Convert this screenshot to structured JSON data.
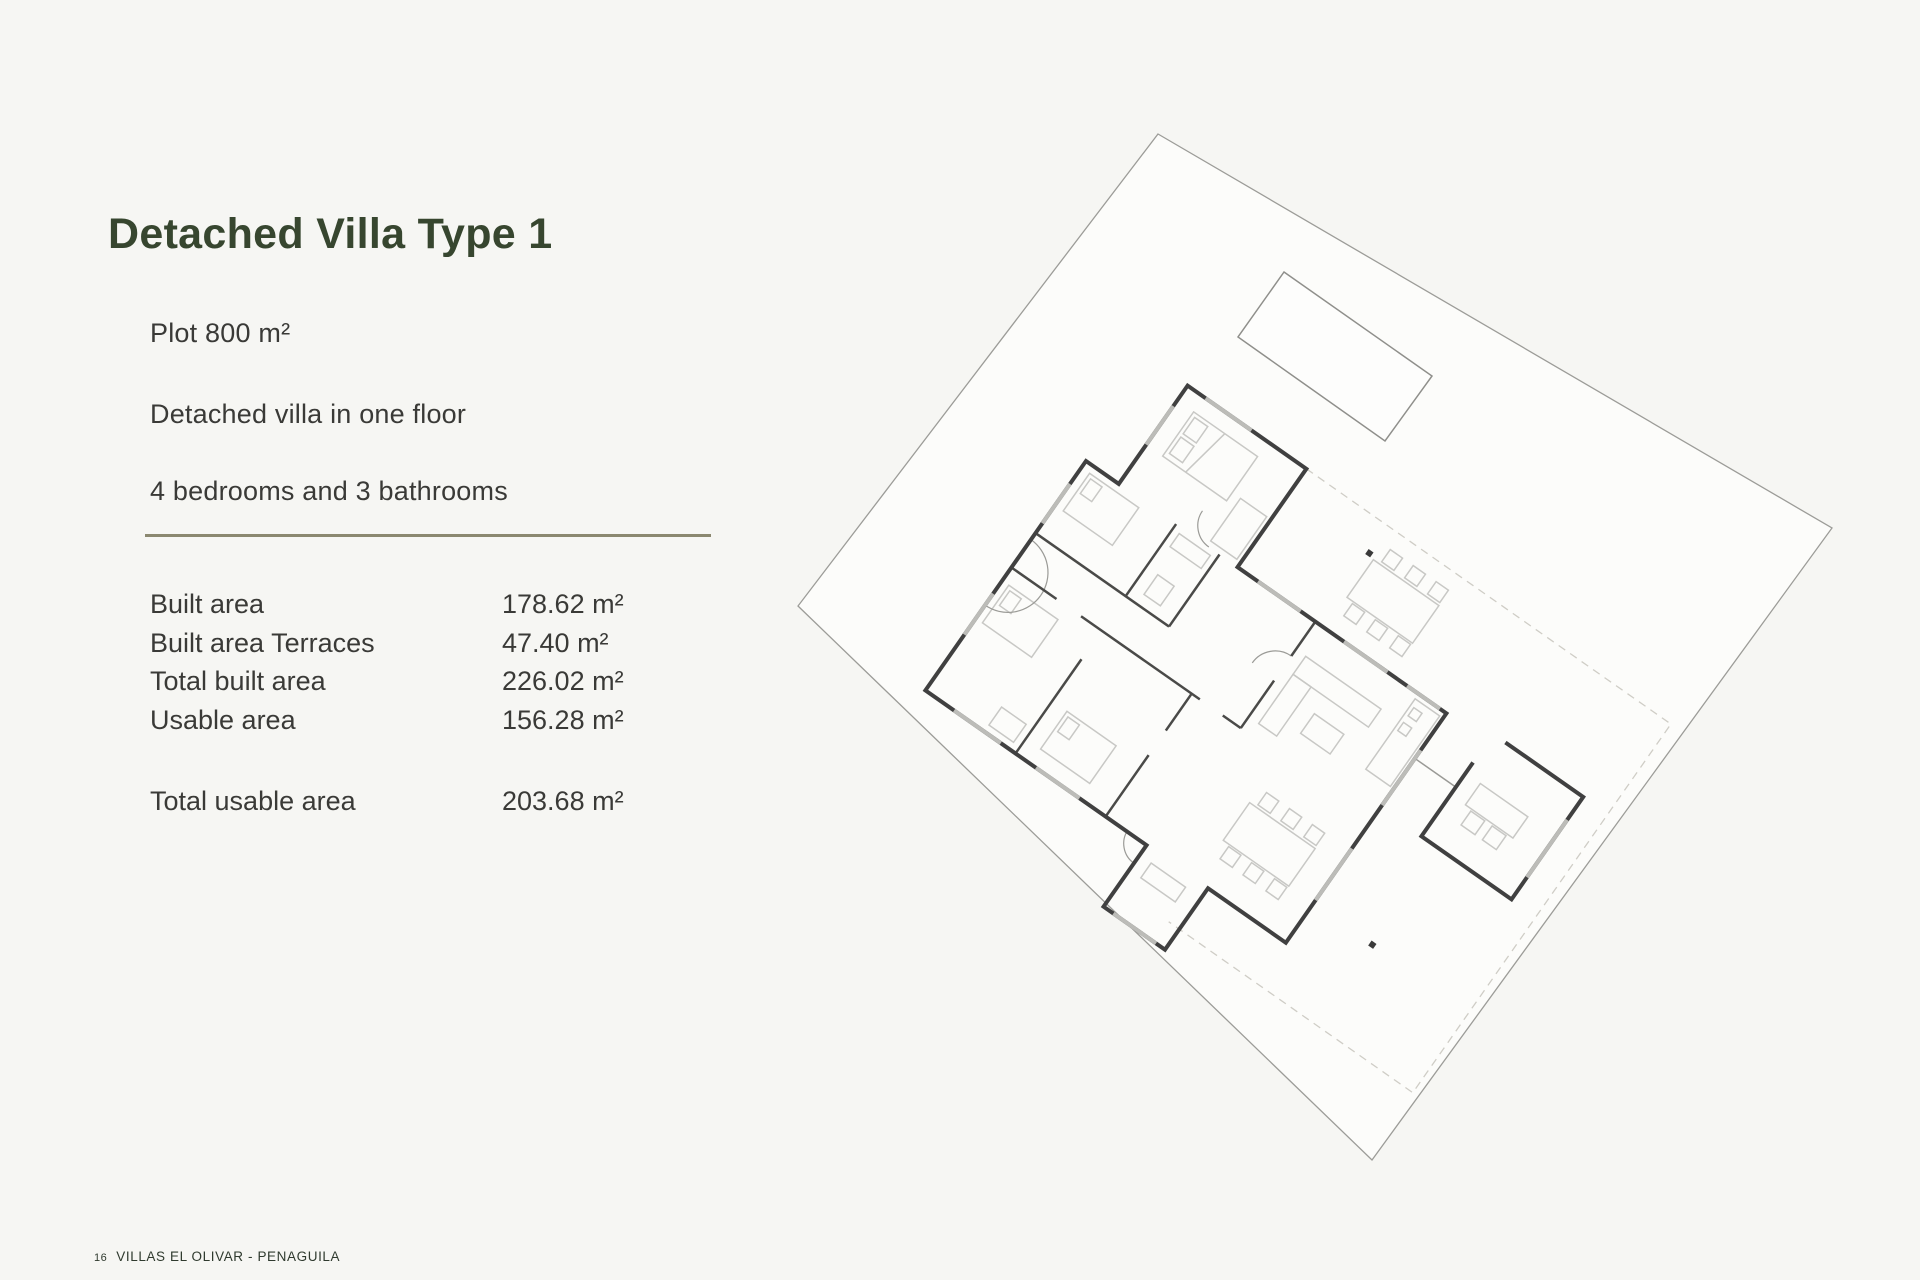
{
  "page": {
    "title": "Detached Villa Type 1"
  },
  "specs": {
    "intro_lines": [
      "Plot 800 m²",
      "Detached villa in one floor",
      "4 bedrooms and 3 bathrooms"
    ],
    "area_rows": [
      {
        "label": "Built area",
        "value": "178.62 m²"
      },
      {
        "label": "Built area Terraces",
        "value": "47.40 m²"
      },
      {
        "label": "Total built area",
        "value": "226.02 m²"
      },
      {
        "label": "Usable area",
        "value": "156.28 m²"
      }
    ],
    "total_row": {
      "label": "Total usable area",
      "value": "203.68 m²"
    }
  },
  "footer": {
    "page_number": "16",
    "project": "VILLAS EL OLIVAR - PENAGUILA"
  },
  "colors": {
    "accent_green": "#37462f",
    "divider_olive": "#8b8870",
    "background": "#f6f6f3"
  }
}
